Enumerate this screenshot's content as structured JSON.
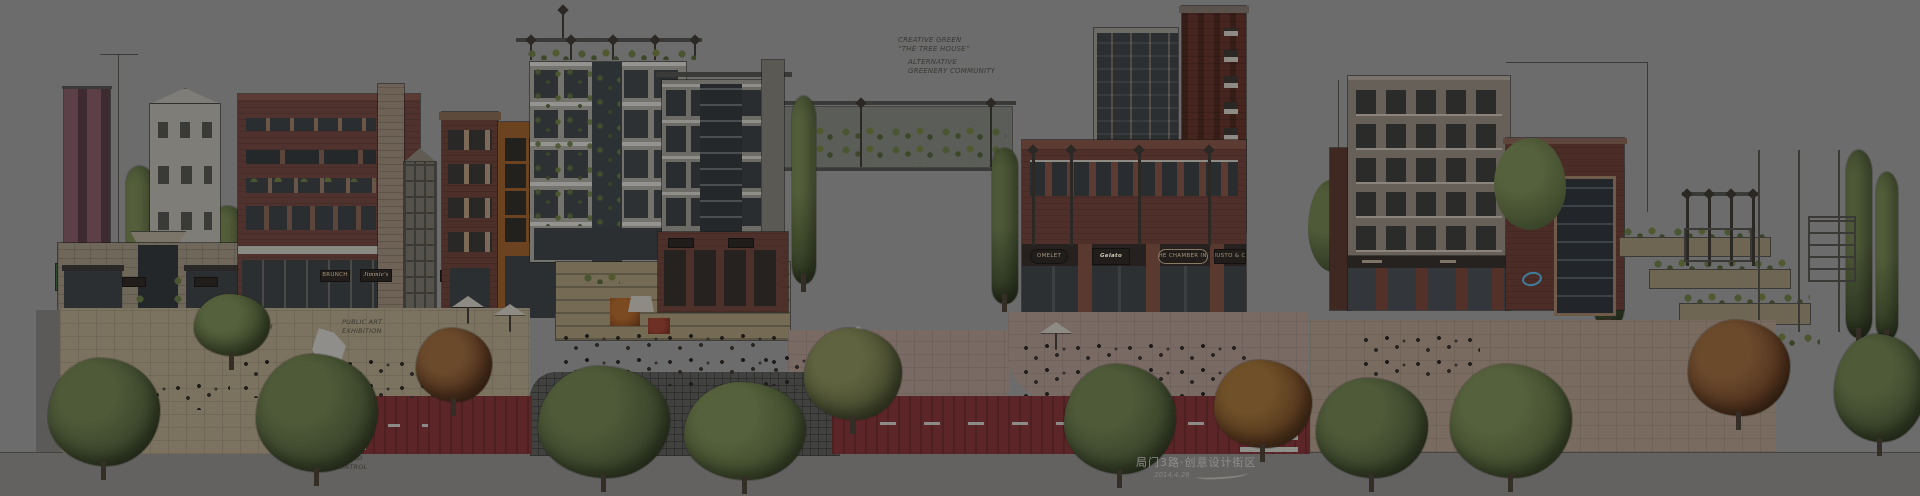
{
  "title_block": {
    "title": "局门3路·创意设计街区",
    "date": "2014.4.26"
  },
  "annotations": {
    "rooftop_note": {
      "line1": "CREATIVE GREEN",
      "line2": "“THE TREE HOUSE”",
      "line3": "ALTERNATIVE",
      "line4": "GREENERY COMMUNITY"
    },
    "wood_platform": "WOOD PLATFORM",
    "public_art_line1": "PUBLIC ART",
    "public_art_line2": "EXHIBITION",
    "street_note_line1": "PLANT BOXES AND",
    "street_note_line2": "CAR PARK CONTROL"
  },
  "signs": {
    "left_storefronts": [
      "BRUNCH",
      "Jimmie's",
      "MELLOW",
      "Bistro"
    ],
    "center_cafe": "Under the Greenery",
    "mid_storefronts": [
      "OMELET",
      "Gelato",
      "THE CHAMBER INN",
      "GIUSTO & CO"
    ]
  },
  "colors": {
    "background": "#6c6c6c",
    "brick_red": "#4e302b",
    "dark_brick": "#46251f",
    "maroon_tower": "#4d3138",
    "concrete_light": "#8f8e89",
    "glass_dark": "#2b2e30",
    "orange_loft": "#6b4320",
    "plaza_tan": "#7b7260",
    "plaza_pink": "#7a6a64",
    "cobble_dark": "#414140",
    "road_red": "#5c2628",
    "crosswalk_white": "#8e8e8b",
    "tree_green": "#3c472c",
    "autumn_red": "#55351f",
    "sign_board": "#211d1a",
    "logo_blue": "#3f7e9e",
    "ink": "#3a3833"
  }
}
